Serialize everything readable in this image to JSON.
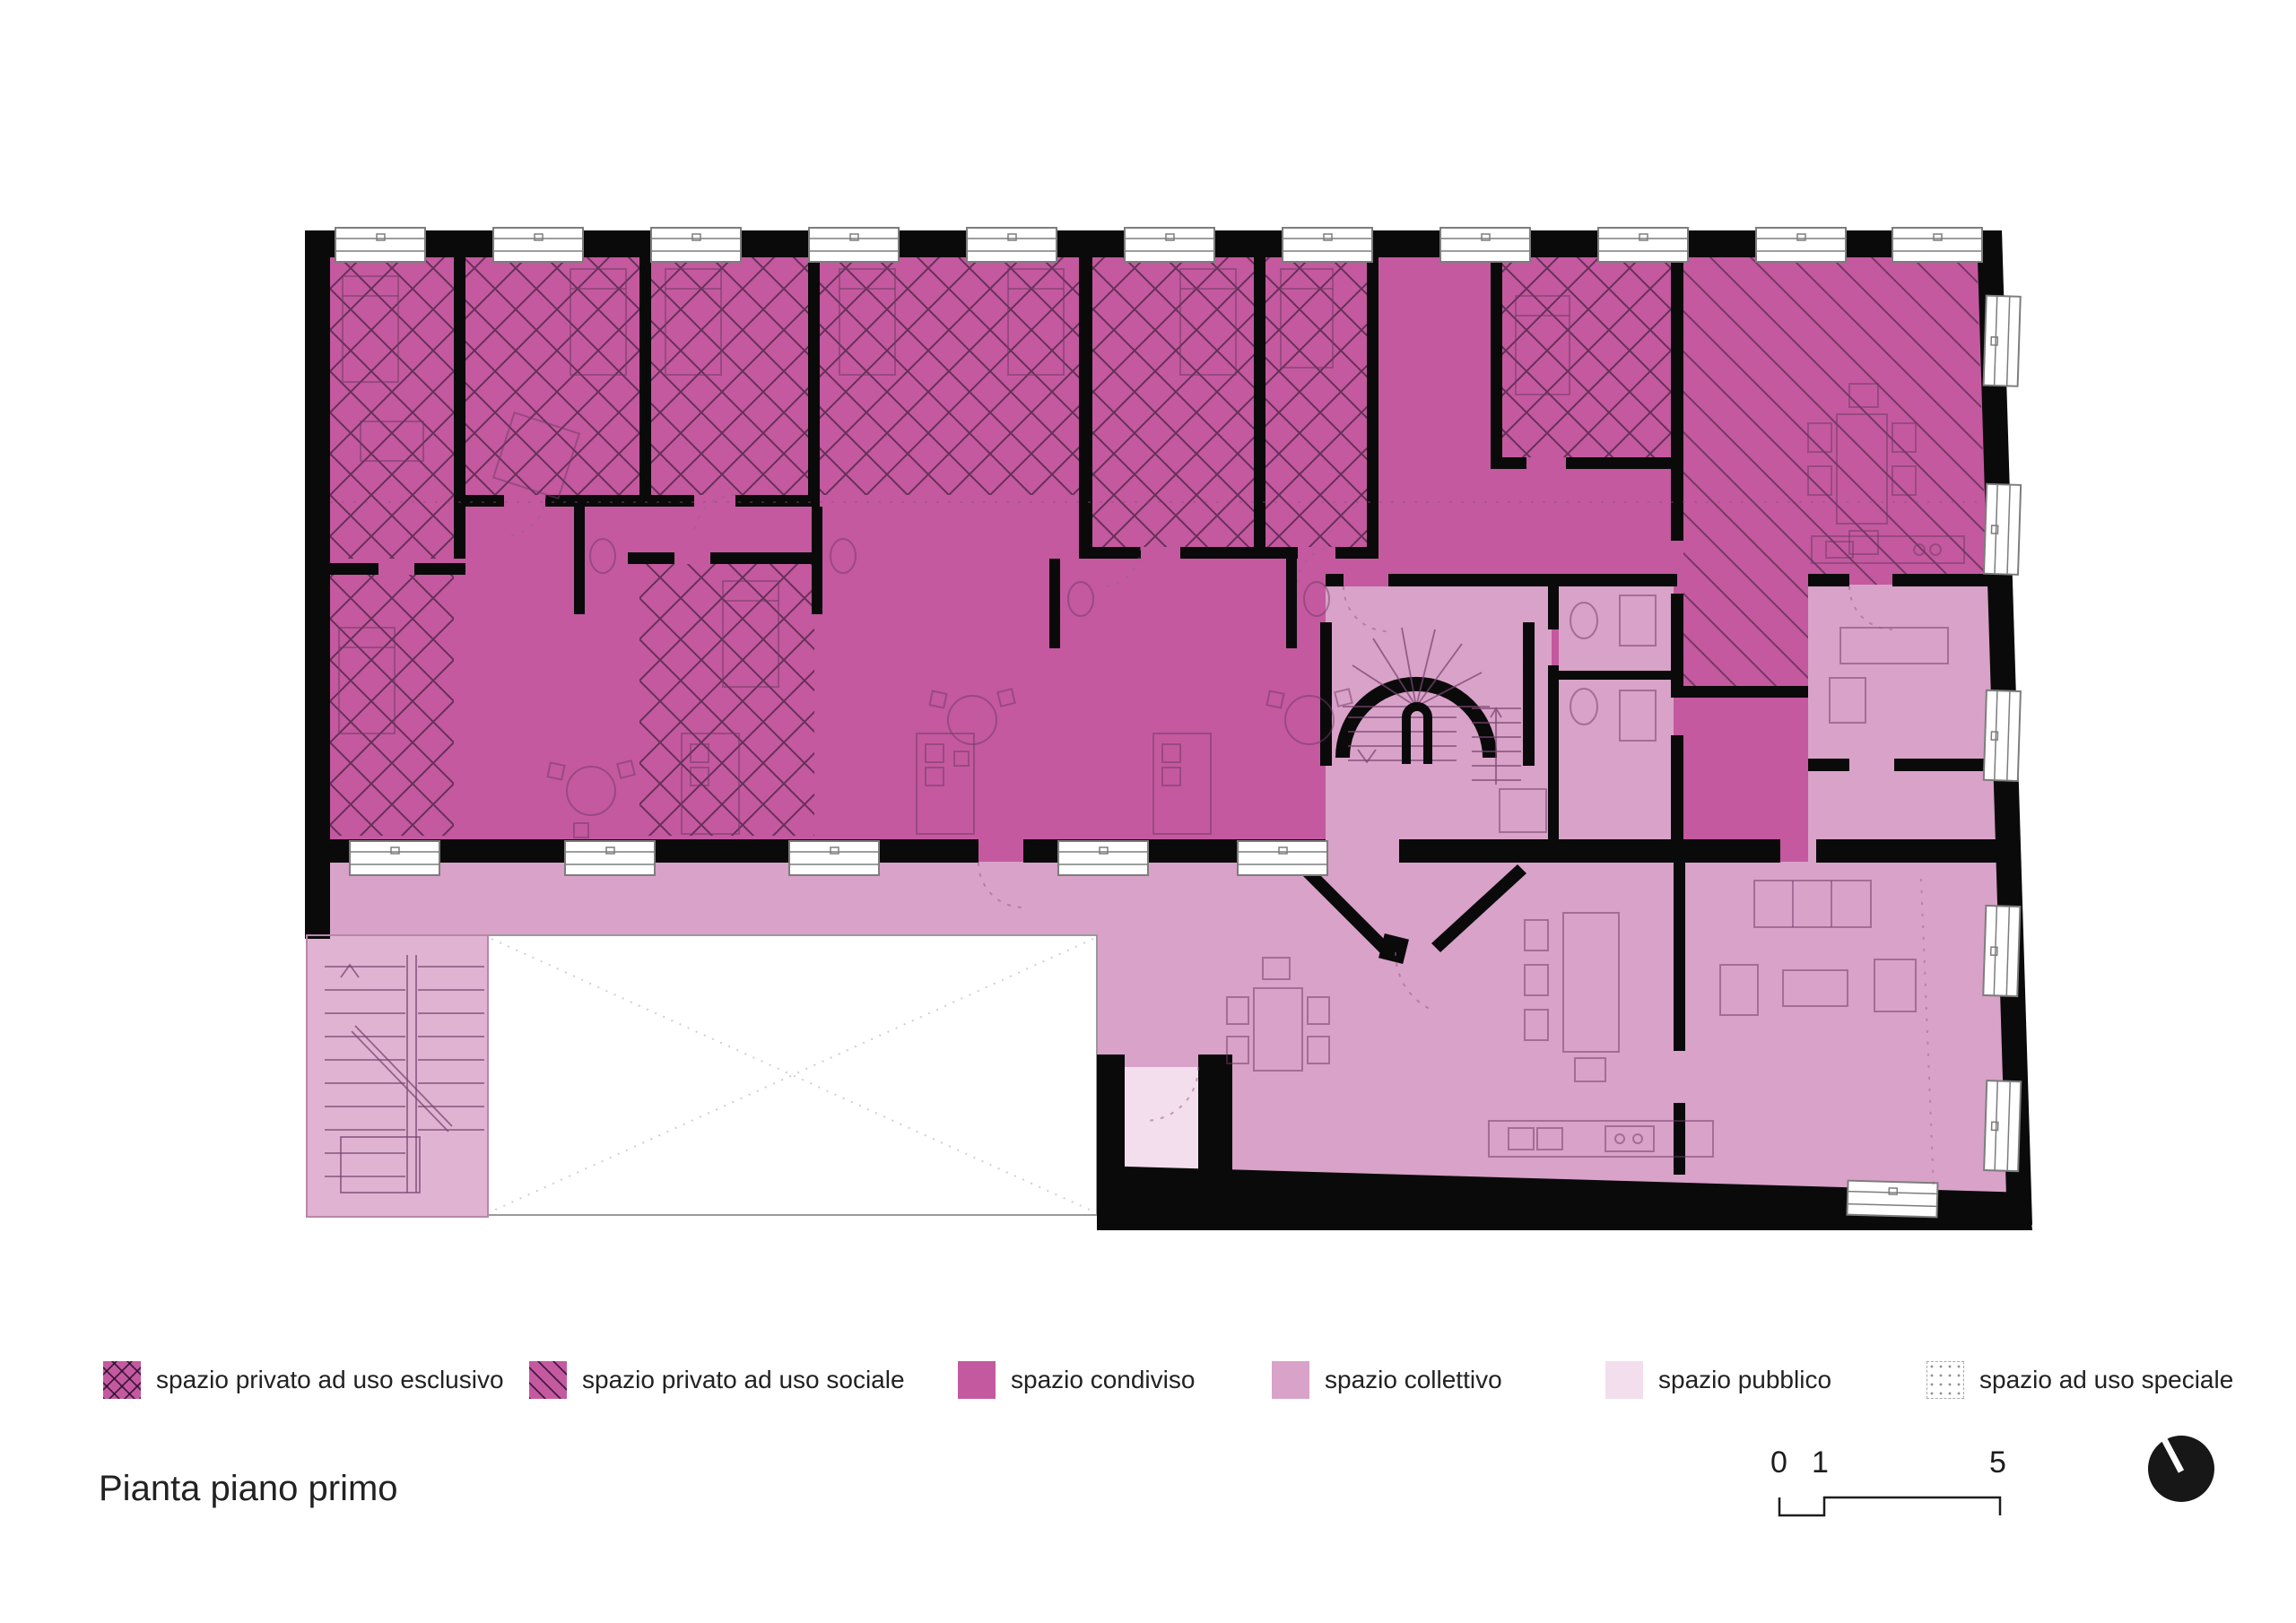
{
  "page": {
    "title": "Pianta piano primo"
  },
  "legend": {
    "items": [
      {
        "label": "spazio privato ad uso esclusivo",
        "swatch": "esclusivo"
      },
      {
        "label": "spazio privato ad uso sociale",
        "swatch": "sociale"
      },
      {
        "label": "spazio condiviso",
        "swatch": "condiviso"
      },
      {
        "label": "spazio collettivo",
        "swatch": "collettivo"
      },
      {
        "label": "spazio pubblico",
        "swatch": "pubblico"
      },
      {
        "label": "spazio ad uso speciale",
        "swatch": "speciale"
      }
    ]
  },
  "scalebar": {
    "start": "0",
    "mid": "1",
    "end": "5"
  },
  "colors": {
    "condiviso": "#c4599f",
    "collettivo": "#d9a2c8",
    "pubblico": "#f3deed",
    "wall": "#0a0a0a",
    "paper": "#ffffff",
    "ink": "#1d1d1f"
  }
}
